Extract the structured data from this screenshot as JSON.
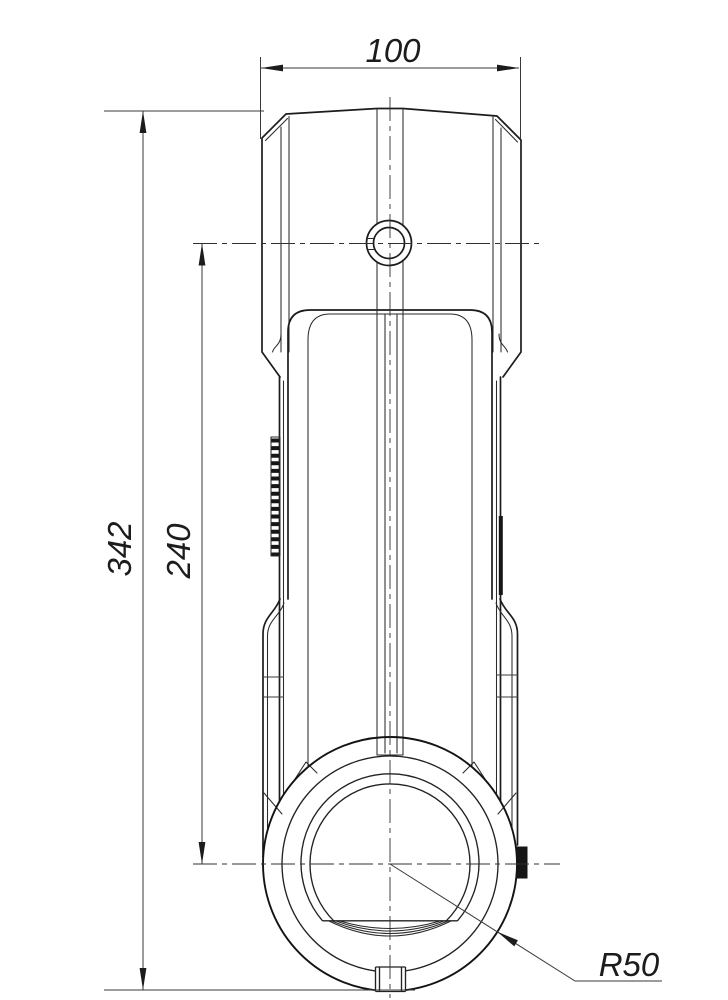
{
  "drawing": {
    "background_color": "#ffffff",
    "line_color": "#1c1c1c",
    "dimension_line_color": "#3a3a3a",
    "dimensions": {
      "top_width": "100",
      "overall_height": "342",
      "center_to_center": "240",
      "bezel_radius": "R50"
    }
  }
}
